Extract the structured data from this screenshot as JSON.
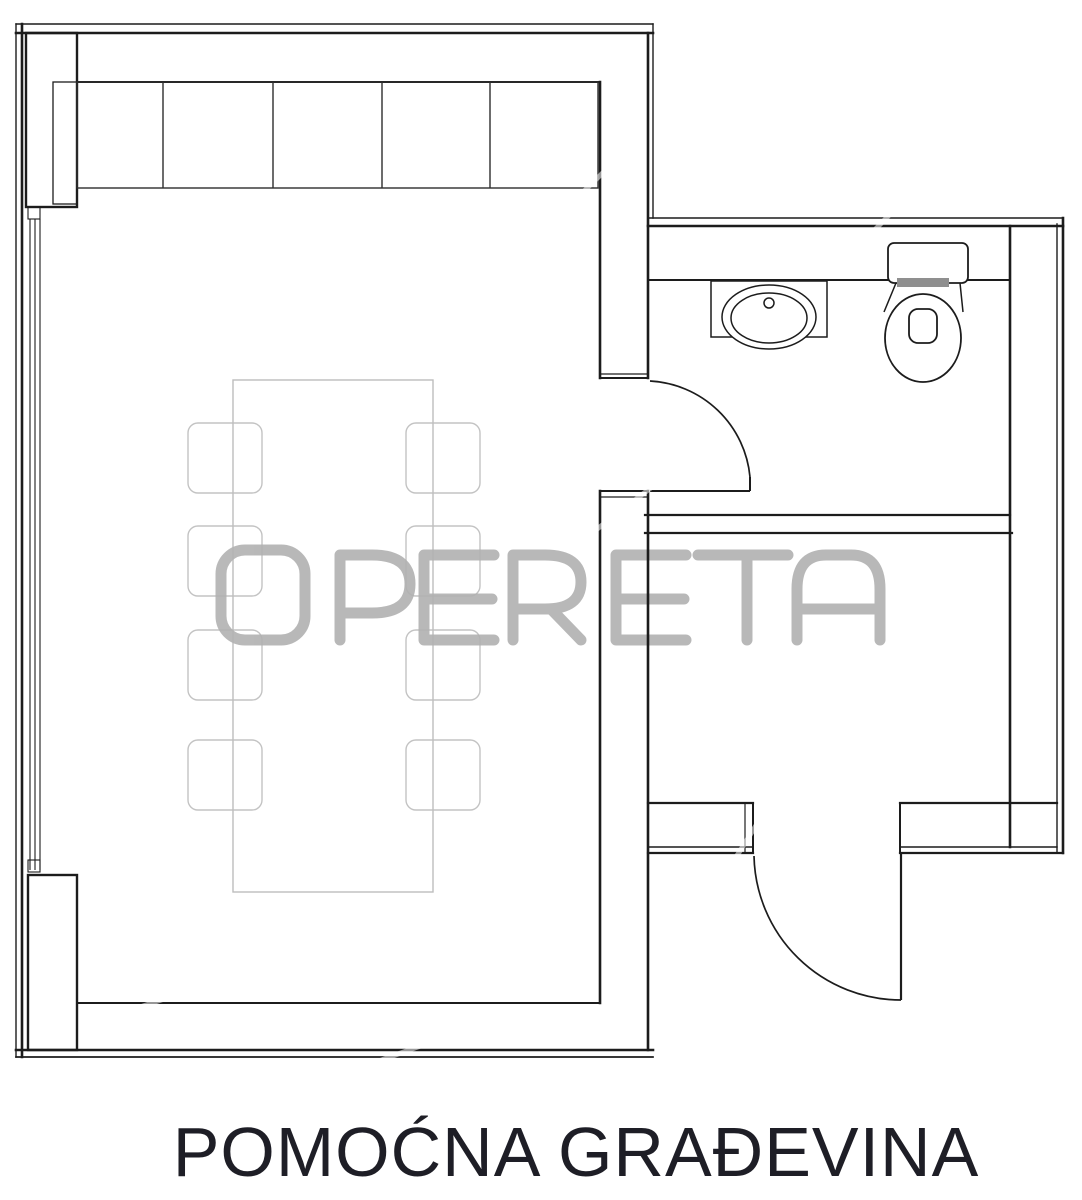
{
  "caption": {
    "text": "POMOĆNA GRAĐEVINA"
  },
  "watermark": {
    "text": "OPERETA"
  },
  "colors": {
    "wall": "#1c1c1c",
    "closet": "#2e2e2e",
    "furniture": "#c3c3c3",
    "watermark": "#b1b1b1",
    "caption": "#1e1e26",
    "paper": "#ffffff"
  }
}
